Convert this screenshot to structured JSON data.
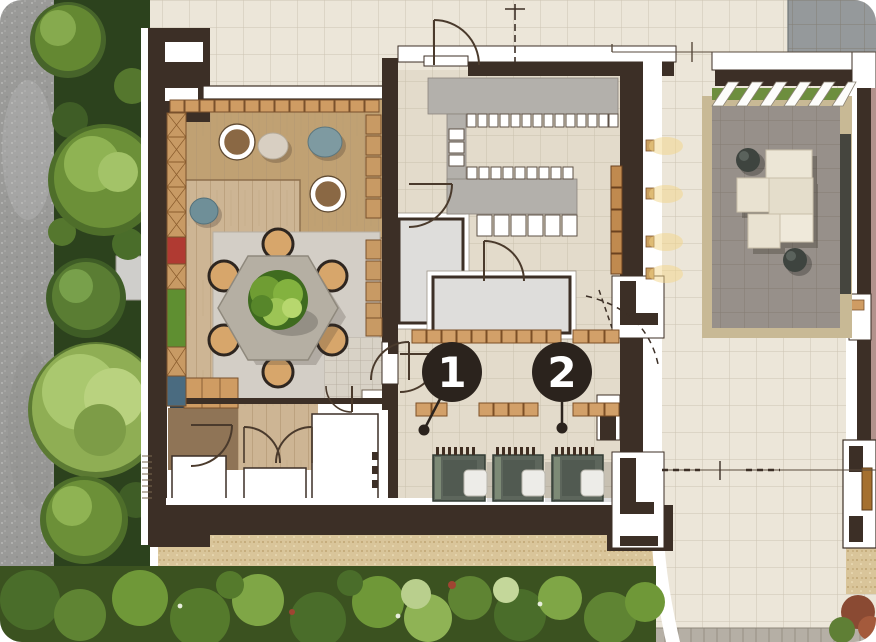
{
  "plan": {
    "type": "architectural-floor-plan",
    "markers": [
      {
        "label": "1"
      },
      {
        "label": "2"
      }
    ],
    "areas": {
      "left": "street-and-trees",
      "top_left": "lounge-platform-room",
      "center_left": "dining-area-hex-table",
      "center": "stair-hall",
      "center_low": "workstation-room",
      "bottom": "gravel-garden",
      "right": "paved-courtyard-with-pergola"
    },
    "colors": {
      "wall": "#3c2f26",
      "wood_floor": "#cdb594",
      "wood_platform": "#c0a173",
      "shelf_wood": "#cf9c63",
      "tile_light": "#ece6d9",
      "tile_warm": "#e3dbcb",
      "stair_gray": "#b3b0ab",
      "room_gray": "#dedddb",
      "dining_mat": "#d3cec6",
      "marker_bg": "#2b231d",
      "marker_text": "#ffffff",
      "desk": "#5d665c",
      "bench": "#d2a069",
      "gravel": "#d9c59a",
      "courtyard_tile": "#97908a",
      "courtyard_band": "#c8b995",
      "cube_seat": "#e9e2d1",
      "pergola_green": "#6d8e3e",
      "greenery": "#4f7428",
      "road": "#9a9a98",
      "accent_red": "#b03a32",
      "accent_green": "#5f8f31",
      "accent_blue": "#4a6b80"
    }
  }
}
